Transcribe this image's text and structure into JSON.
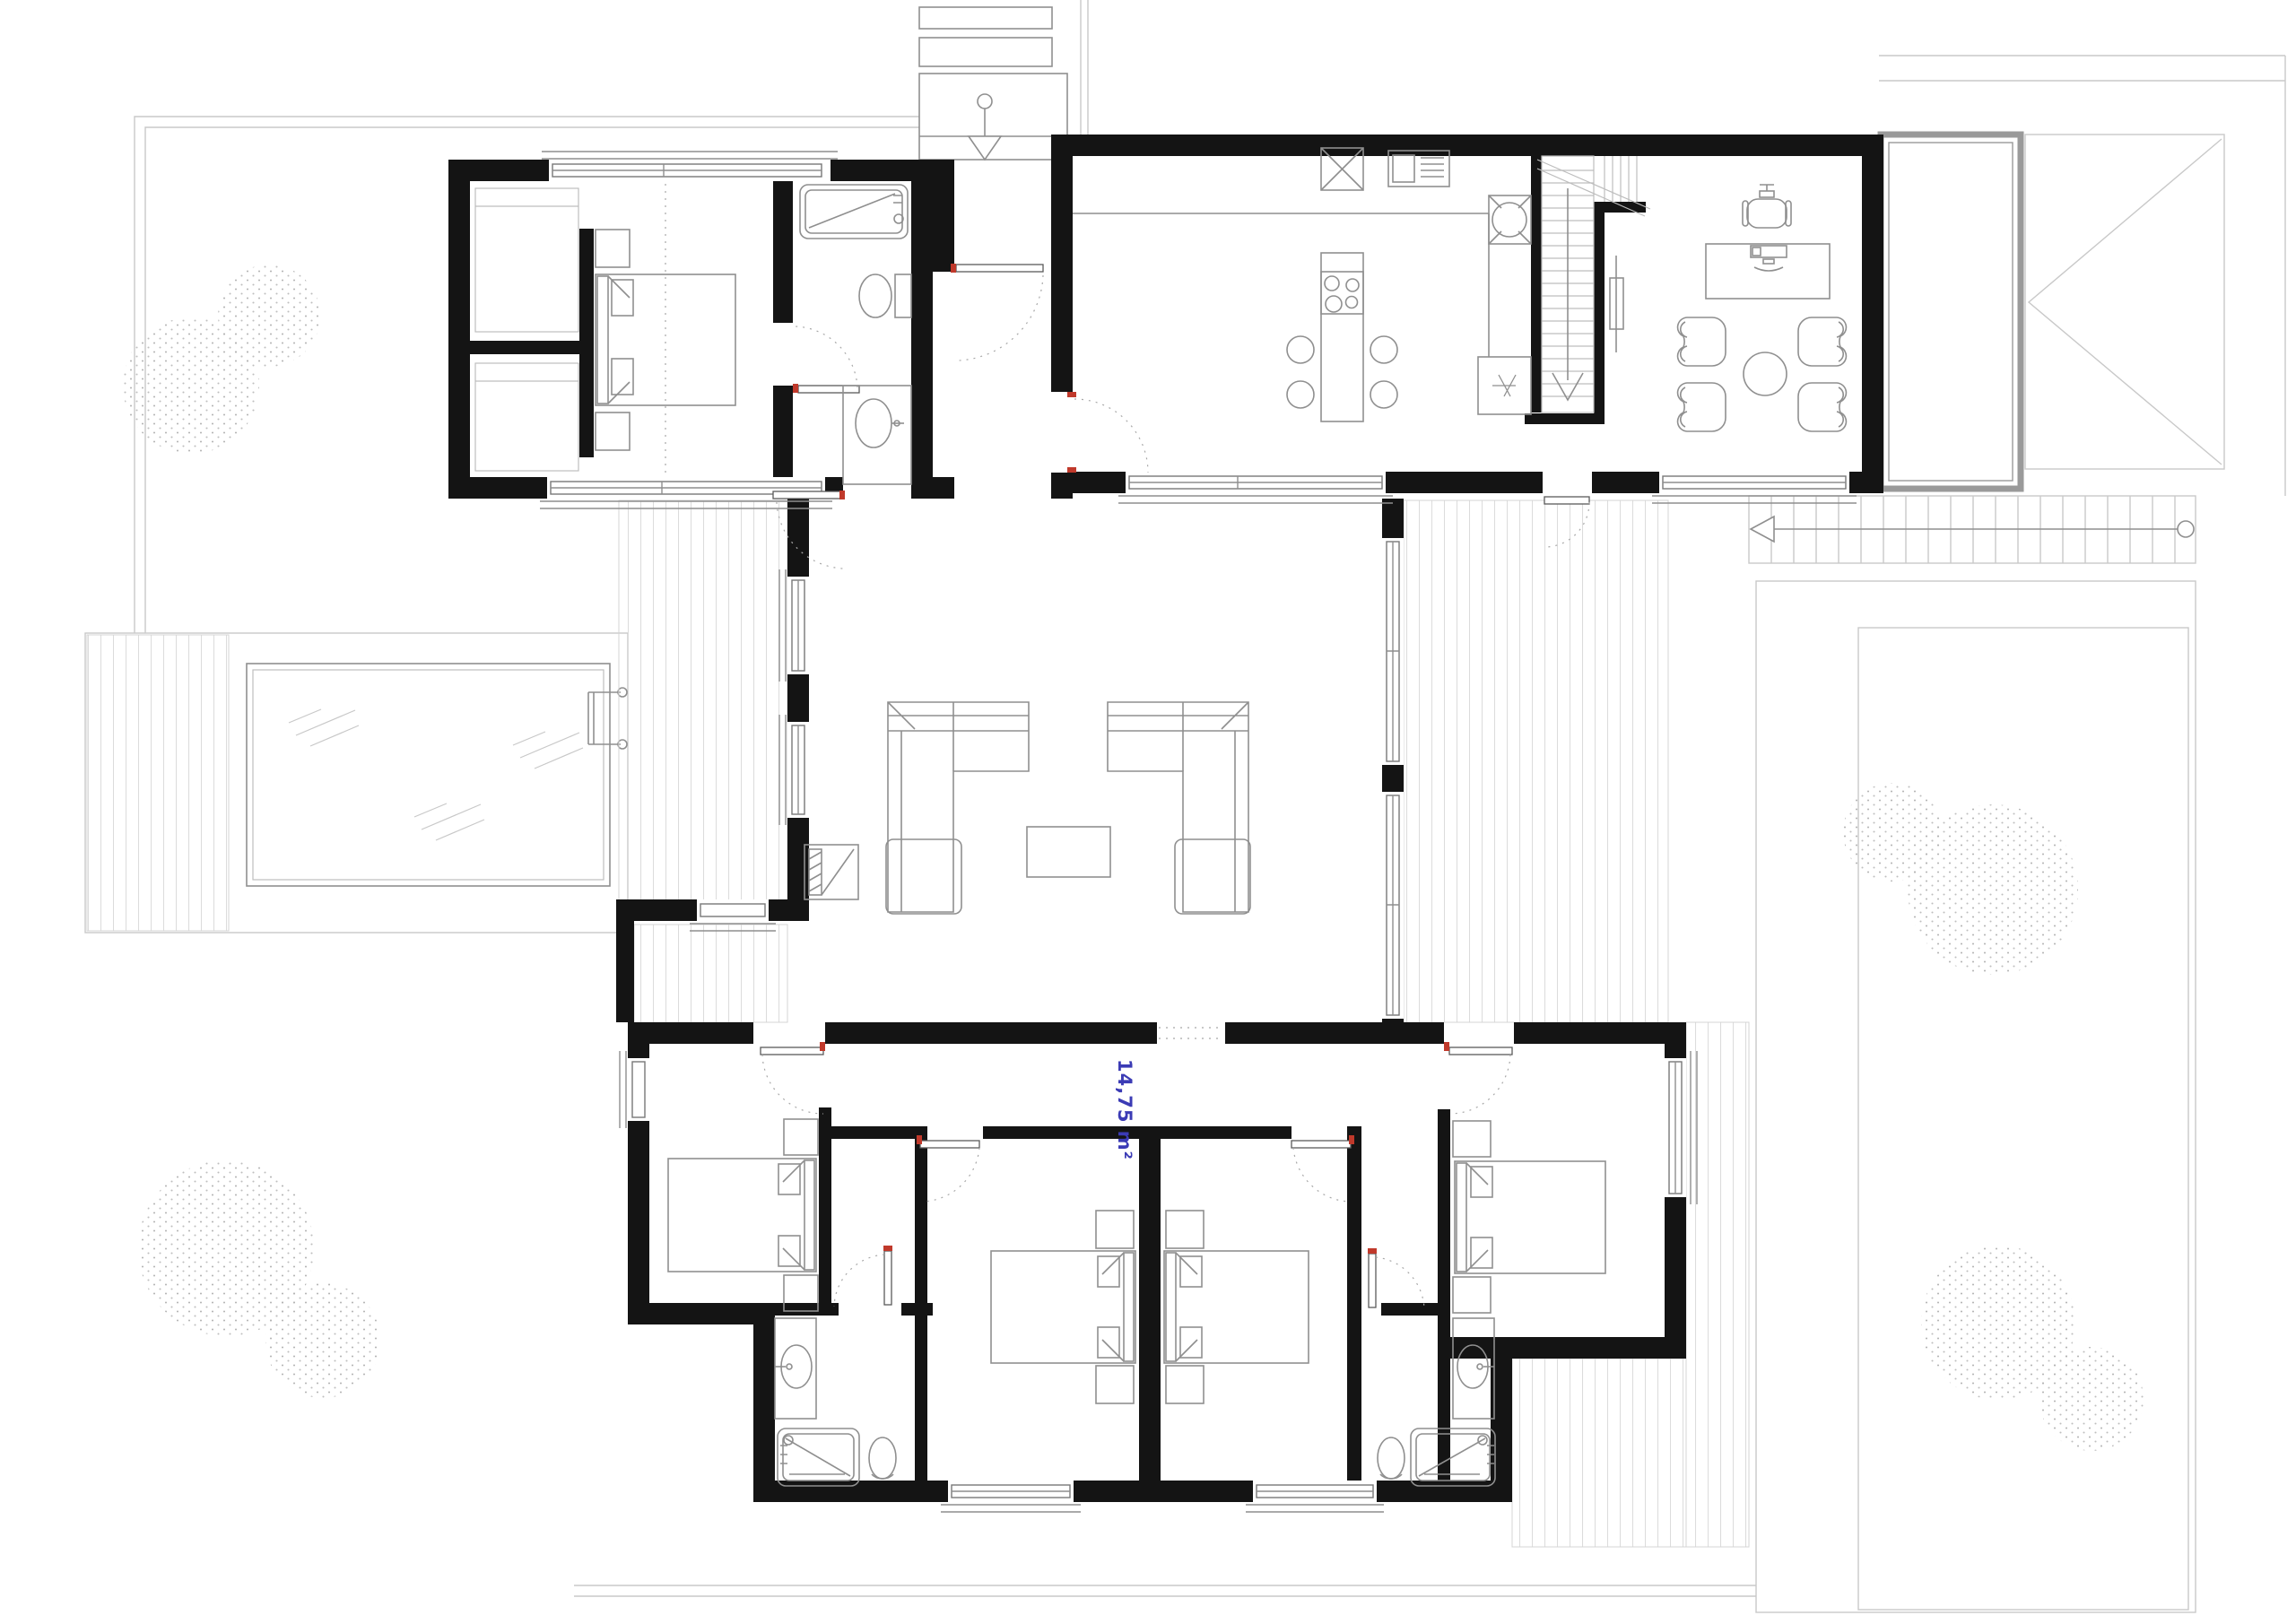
{
  "plan": {
    "type": "architectural-floor-plan",
    "area_label": {
      "text": "14,75 m²"
    },
    "colors": {
      "wall": "#141414",
      "furniture": "#8f8f8f",
      "site": "#c9c9c9",
      "deck_stripe": "#dcdcdc",
      "label": "#3b3bb5",
      "door": "#c0392b",
      "glass": "#9a9a9a"
    },
    "rooms": [
      {
        "name": "master-bedroom",
        "furniture": [
          "double-bed-icon",
          "nightstand-icon",
          "nightstand-icon",
          "wardrobe-icon",
          "wardrobe-icon"
        ]
      },
      {
        "name": "master-bathroom",
        "furniture": [
          "bathtub-icon",
          "toilet-icon",
          "washbasin-icon"
        ]
      },
      {
        "name": "entry-hall",
        "furniture": [
          "front-door-icon",
          "exterior-steps-icon",
          "down-arrow-icon"
        ]
      },
      {
        "name": "kitchen",
        "furniture": [
          "extractor-box-icon",
          "oven-icon",
          "corner-sink-icon",
          "appliance-star-icon",
          "island-cooktop-icon",
          "bar-stool-icon",
          "bar-stool-icon",
          "bar-stool-icon",
          "bar-stool-icon"
        ]
      },
      {
        "name": "staircase",
        "furniture": [
          "stair-flight-icon",
          "down-arrow-icon",
          "handrail-icon"
        ]
      },
      {
        "name": "dining-office",
        "furniture": [
          "desk-icon",
          "monitor-icon",
          "office-chair-icon",
          "round-table-icon",
          "armchair-icon",
          "armchair-icon",
          "armchair-icon",
          "armchair-icon",
          "sideboard-icon"
        ]
      },
      {
        "name": "living-room",
        "furniture": [
          "corner-sofa-icon",
          "corner-sofa-icon",
          "coffee-table-icon",
          "fireplace-icon"
        ]
      },
      {
        "name": "hallway",
        "area_label": "14,75 m²"
      },
      {
        "name": "bedroom-west",
        "furniture": [
          "double-bed-icon",
          "nightstand-icon",
          "nightstand-icon"
        ]
      },
      {
        "name": "bedroom-mid-left",
        "furniture": [
          "double-bed-icon",
          "nightstand-icon",
          "nightstand-icon"
        ]
      },
      {
        "name": "bedroom-mid-right",
        "furniture": [
          "double-bed-icon",
          "nightstand-icon",
          "nightstand-icon"
        ]
      },
      {
        "name": "bedroom-east",
        "furniture": [
          "double-bed-icon",
          "nightstand-icon",
          "nightstand-icon"
        ]
      },
      {
        "name": "bathroom-west",
        "furniture": [
          "washbasin-icon",
          "bathtub-icon",
          "toilet-icon"
        ]
      },
      {
        "name": "bathroom-east",
        "furniture": [
          "washbasin-icon",
          "bathtub-icon",
          "toilet-icon"
        ]
      }
    ],
    "outdoor": {
      "features": [
        "swimming-pool-icon",
        "pool-ladder-icon",
        "wood-deck-icon",
        "wood-deck-icon",
        "wood-deck-icon",
        "tree-icon",
        "tree-icon",
        "tree-icon",
        "tree-icon",
        "walkway-arrow-icon",
        "carport-chevron-icon",
        "glazed-screen-icon",
        "site-boundary-icon",
        "lawn-icon"
      ]
    }
  }
}
